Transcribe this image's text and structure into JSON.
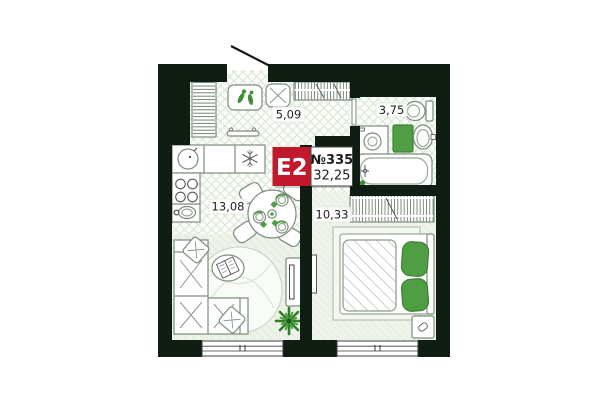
{
  "floorplan": {
    "badge": {
      "unit_type": "E2",
      "unit_number": "№335",
      "total_area": "32,25"
    },
    "rooms": {
      "hallway": {
        "area": "5,09"
      },
      "bathroom": {
        "area": "3,75"
      },
      "kitchen_living": {
        "area": "13,08"
      },
      "bedroom": {
        "area": "10,33"
      }
    },
    "colors": {
      "wall": "#101d12",
      "badge_red": "#c2182b",
      "accent_green": "#4f9e43",
      "accent_green_dark": "#3e8034",
      "tile_line": "#d7e5d2",
      "plank_line": "#dce8d6",
      "outline": "#7d8d7d"
    }
  }
}
